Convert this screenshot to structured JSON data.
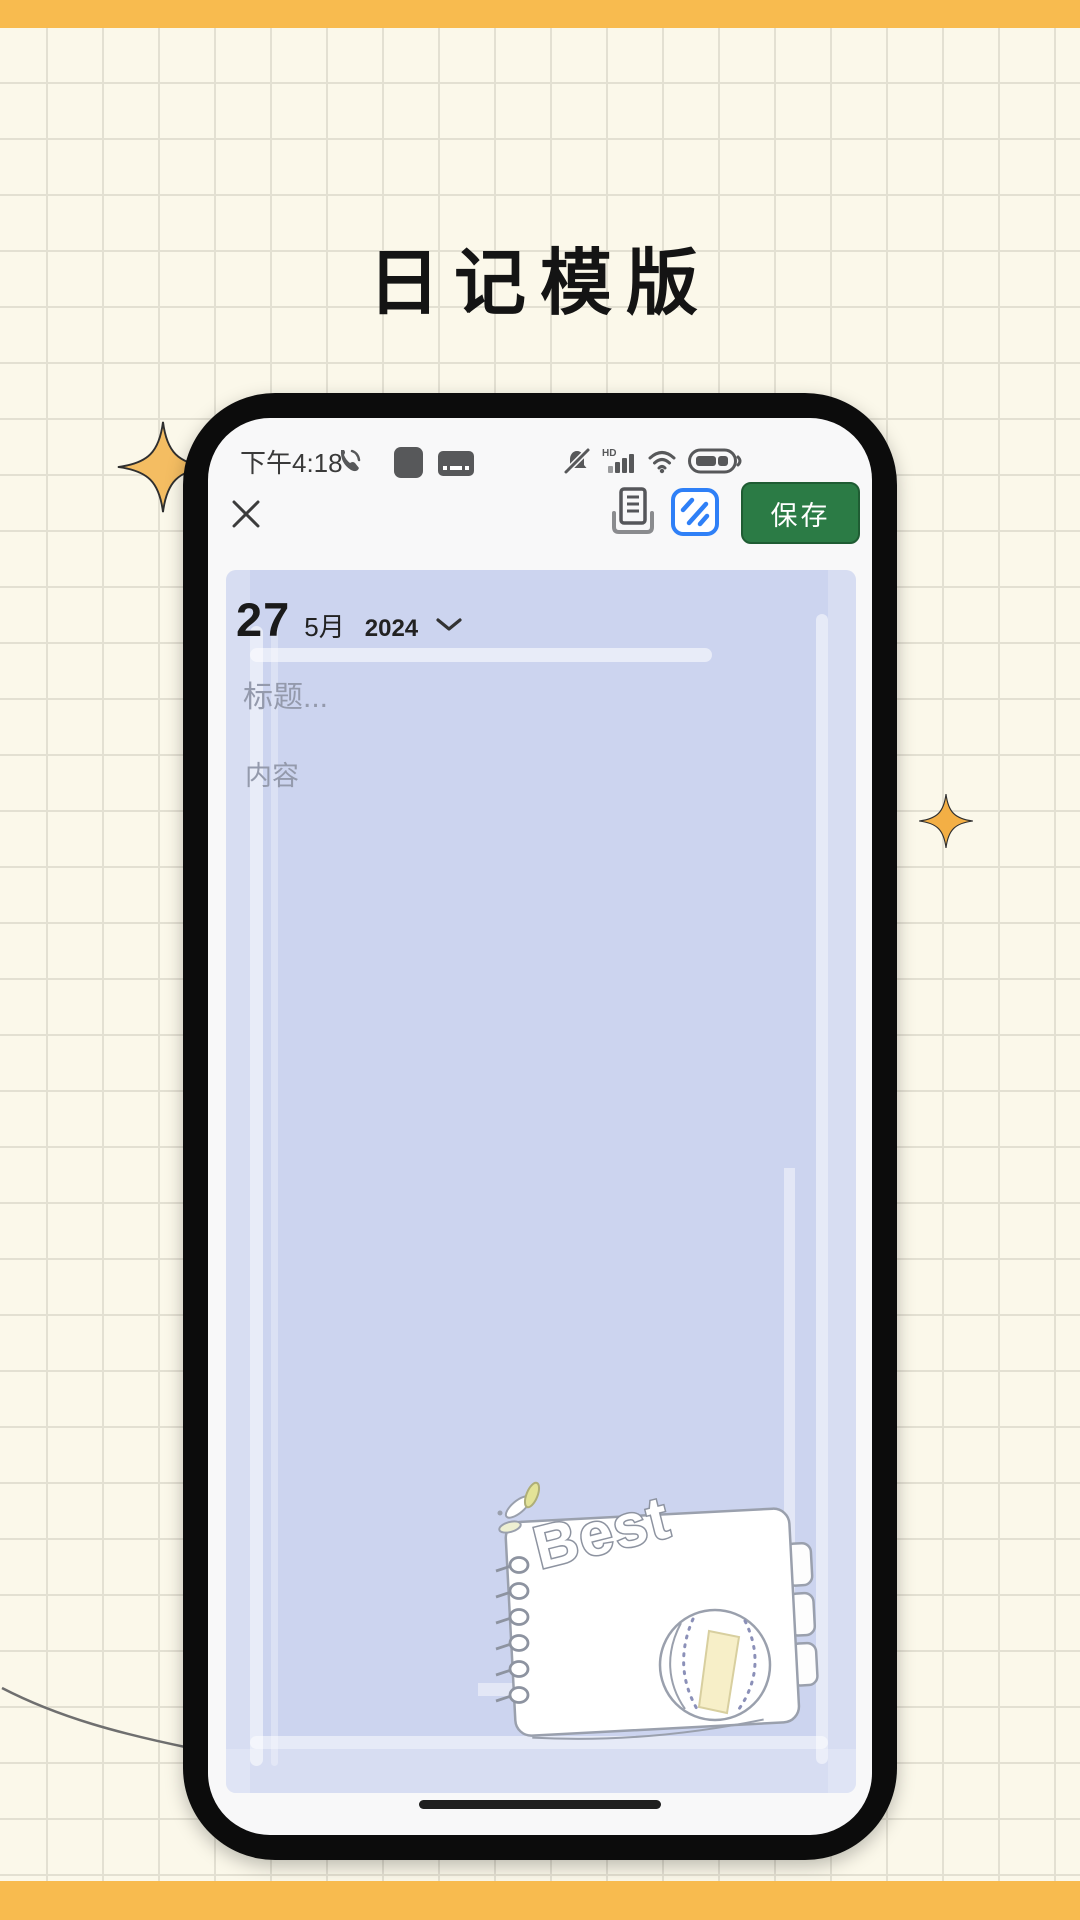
{
  "page": {
    "title": "日记模版"
  },
  "colors": {
    "accent_bar": "#f8bb4f",
    "background": "#fbf8ea",
    "grid_line": "#e3e0d2",
    "panel_lavender": "#ccd4ef",
    "save_green": "#2b7b45",
    "template_blue": "#2f80f7",
    "sparkle_orange": "#f4bd62",
    "placeholder_gray": "#949aac"
  },
  "phone": {
    "status": {
      "time": "下午4:18",
      "hd_label": "HD"
    },
    "toolbar": {
      "save_label": "保存"
    },
    "editor": {
      "day": "27",
      "month": "5月",
      "year": "2024",
      "title_placeholder": "标题...",
      "content_placeholder": "内容"
    },
    "sticker": {
      "label": "Best"
    }
  },
  "icons": {
    "status_left": [
      "call-icon",
      "app-square-icon",
      "keyboard-icon"
    ],
    "status_right": [
      "mute-icon",
      "signal-icon",
      "wifi-icon",
      "battery-icon"
    ],
    "toolbar": [
      "close-icon",
      "print-icon",
      "template-icon"
    ],
    "decor": [
      "sparkle-icon",
      "chevron-down-icon",
      "home-indicator"
    ]
  }
}
